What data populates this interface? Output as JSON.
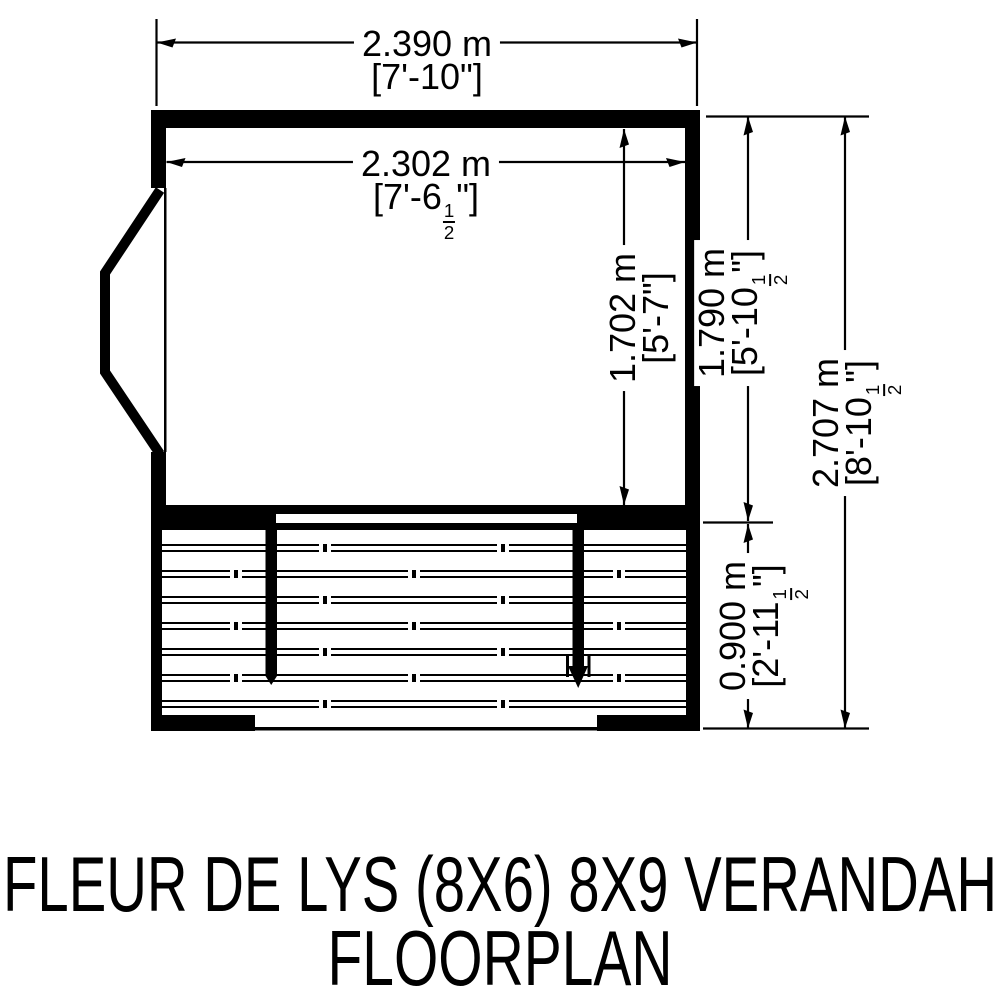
{
  "colors": {
    "ink": "#000000",
    "background": "#ffffff"
  },
  "title": {
    "line1": "FLEUR DE LYS (8X6) 8X9 VERANDAH",
    "line2": "FLOORPLAN"
  },
  "dimensions": {
    "overall_width": {
      "metric": "2.390 m",
      "imp_pre": "[7'-10\"]",
      "frac_num": "",
      "frac_den": "",
      "imp_post": ""
    },
    "internal_width": {
      "metric": "2.302 m",
      "imp_pre": "[7'-6",
      "frac_num": "1",
      "frac_den": "2",
      "imp_post": "\"]"
    },
    "internal_depth": {
      "metric": "1.702 m",
      "imp_pre": "[5'-7\"]",
      "frac_num": "",
      "frac_den": "",
      "imp_post": ""
    },
    "shed_depth": {
      "metric": "1.790 m",
      "imp_pre": "[5'-10",
      "frac_num": "1",
      "frac_den": "2",
      "imp_post": "\"]"
    },
    "overall_depth": {
      "metric": "2.707 m",
      "imp_pre": "[8'-10",
      "frac_num": "1",
      "frac_den": "2",
      "imp_post": "\"]"
    },
    "verandah_depth": {
      "metric": "0.900 m",
      "imp_pre": "[2'-11",
      "frac_num": "1",
      "frac_den": "2",
      "imp_post": "\"]"
    }
  },
  "verandah": {
    "deck_board_rows": 7,
    "post_count": 2
  }
}
